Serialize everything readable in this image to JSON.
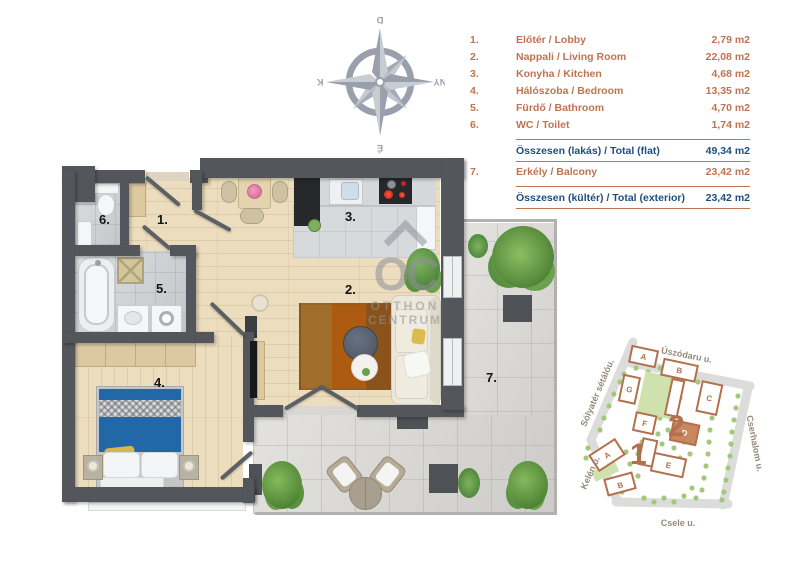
{
  "legend": {
    "rows": [
      {
        "num": "1.",
        "name": "Előtér / Lobby",
        "area": "2,79 m2"
      },
      {
        "num": "2.",
        "name": "Nappali / Living Room",
        "area": "22,08 m2"
      },
      {
        "num": "3.",
        "name": "Konyha / Kitchen",
        "area": "4,68 m2"
      },
      {
        "num": "4.",
        "name": "Hálószoba / Bedroom",
        "area": "13,35 m2"
      },
      {
        "num": "5.",
        "name": "Fürdő / Bathroom",
        "area": "4,70 m2"
      },
      {
        "num": "6.",
        "name": "WC / Toilet",
        "area": "1,74 m2"
      }
    ],
    "total_flat_label": "Összesen (lakás) / Total (flat)",
    "total_flat_area": "49,34 m2",
    "balcony_num": "7.",
    "balcony_name": "Erkély / Balcony",
    "balcony_area": "23,42 m2",
    "total_ext_label": "Összesen (kültér) / Total (exterior)",
    "total_ext_area": "23,42 m2"
  },
  "colors": {
    "accent": "#bf7350",
    "total_text": "#1e4f7d",
    "wall": "#53565b",
    "map_outline": "#b2704e",
    "map_highlight": "#c9875f"
  },
  "compass": {
    "up": "D",
    "right": "NY",
    "down": "É",
    "left": "K"
  },
  "plan_labels": {
    "lobby": "1.",
    "living": "2.",
    "kitchen": "3.",
    "bedroom": "4.",
    "bathroom": "5.",
    "wc": "6.",
    "balcony": "7."
  },
  "watermark": {
    "monogram": "OC",
    "line1": "OTTHON",
    "line2": "CENTRUM"
  },
  "sitemap": {
    "streets": {
      "top": "Úszódaru u.",
      "left": "Sólyatér sétálóu.",
      "bottom_left": "Kelén u.",
      "bottom": "Csele u.",
      "right": "Cserhalom u."
    },
    "block1_label": "1",
    "block2_label": "2",
    "block1_buildings": [
      "A",
      "B"
    ],
    "block2_buildings": [
      "A",
      "B",
      "C",
      "D",
      "E",
      "F",
      "G"
    ]
  }
}
